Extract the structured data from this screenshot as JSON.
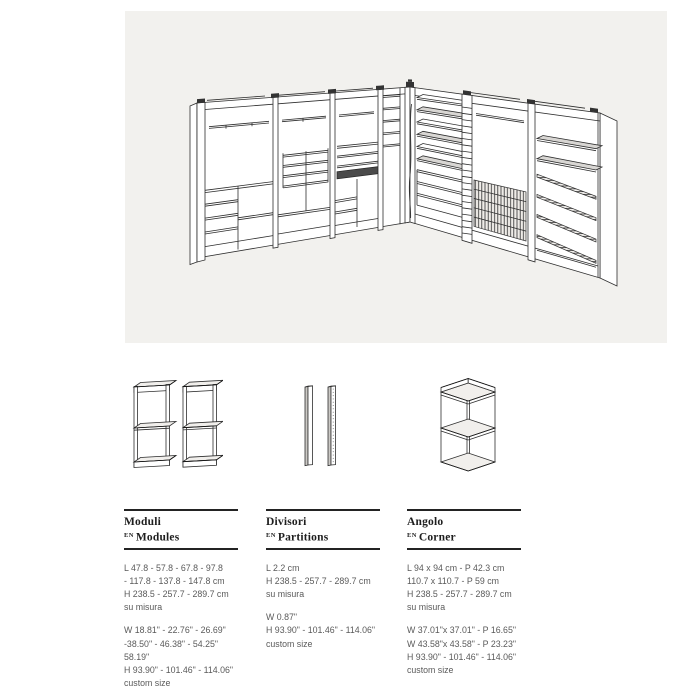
{
  "hero": {
    "drawing": "L-shaped walk-in closet system, isometric line drawing",
    "background": "#f2f1ee"
  },
  "colors": {
    "page_bg": "#ffffff",
    "hero_bg": "#f2f1ee",
    "line_art": "#2e2e2e",
    "heading_text": "#1e1e1e",
    "body_text": "#5a5a5a",
    "rule": "#232323"
  },
  "columns": [
    {
      "title_it": "Moduli",
      "en_tag": "EN",
      "title_en": "Modules",
      "metric": "L 47.8 - 57.8 - 67.8 - 97.8\n- 117.8 - 137.8 - 147.8 cm\nH 238.5 - 257.7 - 289.7 cm\nsu misura",
      "imperial": "W 18.81\" - 22.76\" - 26.69\"\n-38.50\" - 46.38\" - 54.25\"\n58.19\"\nH 93.90\" - 101.46\" - 114.06\"\ncustom size"
    },
    {
      "title_it": "Divisori",
      "en_tag": "EN",
      "title_en": "Partitions",
      "metric": "L 2.2 cm\nH 238.5 - 257.7 - 289.7 cm\n su misura",
      "imperial": "W 0.87\"\nH 93.90\" - 101.46\" - 114.06\"\ncustom size"
    },
    {
      "title_it": "Angolo",
      "en_tag": "EN",
      "title_en": "Corner",
      "metric": "L 94 x 94 cm - P 42.3 cm\n110.7 x 110.7 - P 59 cm\nH 238.5 - 257.7 - 289.7 cm\nsu misura",
      "imperial": "W 37.01\"x 37.01\" - P 16.65\"\nW 43.58\"x 43.58\" - P 23.23\"\nH 93.90\" - 101.46\" - 114.06\"\ncustom size"
    }
  ]
}
